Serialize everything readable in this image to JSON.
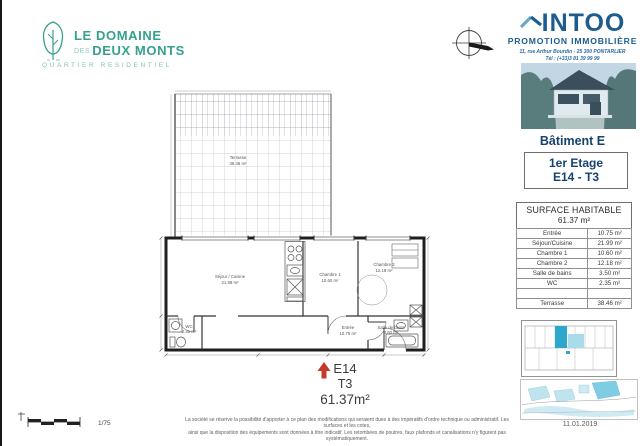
{
  "branding": {
    "line1": "LE DOMAINE",
    "des": "DES",
    "line2": "DEUX MONTS",
    "subtitle": "QUARTIER RESIDENTIEL",
    "teal": "#35a08e"
  },
  "developer": {
    "name": "INTOO",
    "tagline": "PROMOTION IMMOBILIÈRE",
    "address": "11, rue Arthur Bourdin - 25 300 PONTARLIER",
    "phone": "Tél : (+33)3 81 39 99 99",
    "blue": "#1d5c8f"
  },
  "unit": {
    "building": "Bâtiment E",
    "floor": "1er Etage",
    "ref": "E14 - T3"
  },
  "summary": {
    "code": "E14",
    "type": "T3",
    "area": "61.37m²",
    "arrow_color": "#c23b2a"
  },
  "surface_table": {
    "title": "SURFACE HABITABLE",
    "total": "61.37 m²",
    "rows": [
      {
        "label": "Entrée",
        "value": "10.75 m²"
      },
      {
        "label": "Séjour/Cuisine",
        "value": "21.99 m²"
      },
      {
        "label": "Chambre 1",
        "value": "10.60 m²"
      },
      {
        "label": "Chambre 2",
        "value": "12.18 m²"
      },
      {
        "label": "Salle de bains",
        "value": "3.50 m²"
      },
      {
        "label": "WC",
        "value": "2.35 m²"
      },
      {
        "label": "",
        "value": ""
      },
      {
        "label": "Terrasse",
        "value": "38.46 m²"
      }
    ]
  },
  "plan": {
    "terrace": {
      "name": "Terrasse",
      "area": "38.46 m²"
    },
    "rooms": [
      {
        "name": "Séjour / Cuisine",
        "area": "21.99 m²"
      },
      {
        "name": "Chambre 1",
        "area": "10.60 m²"
      },
      {
        "name": "Chambre 2",
        "area": "12.18 m²"
      },
      {
        "name": "Entrée",
        "area": "10.75 m²"
      },
      {
        "name": "Salle de bains",
        "area": "3.50 m²"
      },
      {
        "name": "WC",
        "area": "2.35 m²"
      }
    ],
    "highlight_blue": "#2da7cb",
    "light_blue": "#a8dcea"
  },
  "footer": {
    "scale": "1/75",
    "disclaimer1": "La société se réserve la possibilité d'apporter à ce plan des modifications qui seraient dues à des impératifs d'ordre technique ou administratif. Les surfaces et les cotes,",
    "disclaimer2": "ainsi que la disposition des équipements sont données à titre indicatif. Les retombées de poutres, faux plafonds et canalisations n'y figurent pas systématiquement.",
    "date": "11.01.2019"
  }
}
